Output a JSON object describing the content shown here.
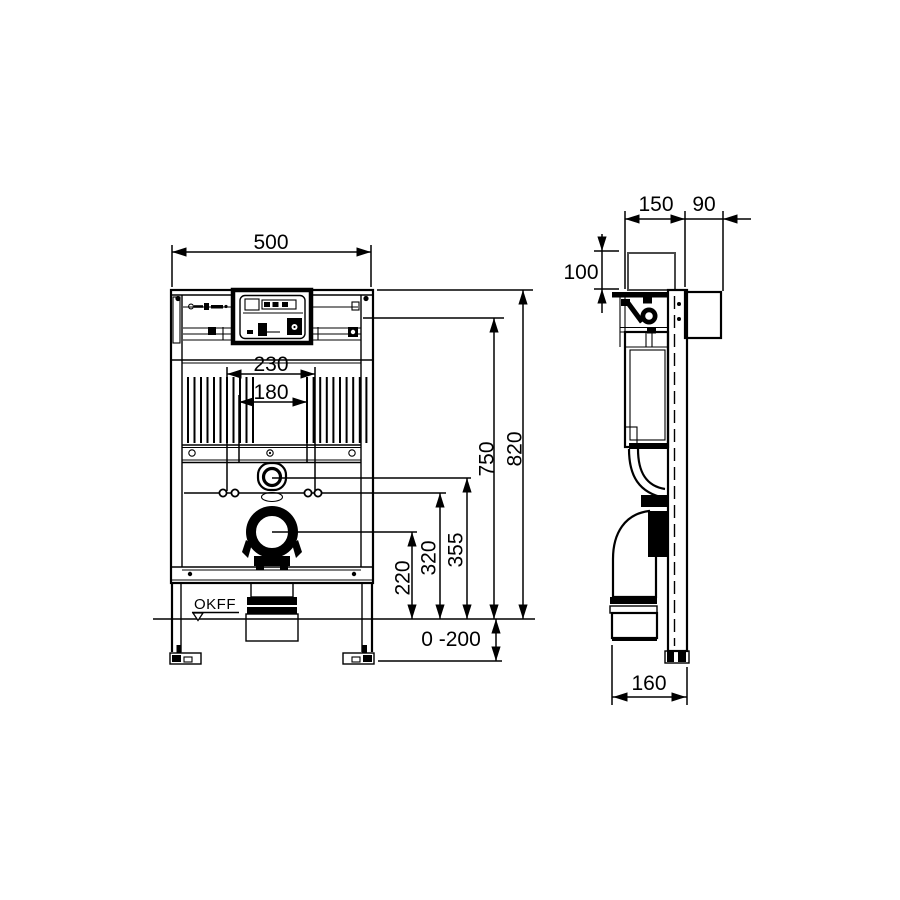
{
  "drawing": {
    "type": "technical-installation-drawing",
    "views": {
      "front": "front elevation",
      "side": "side elevation"
    },
    "colors": {
      "line": "#000000",
      "background": "#ffffff",
      "secondary_line": "#4a4a4a"
    },
    "front": {
      "width": "500",
      "fixing_spacing_outer": "230",
      "fixing_spacing_inner": "180",
      "total_height": "820",
      "upper_leader_height": "750",
      "flush_bend_height": "355",
      "fixing_height": "320",
      "drain_height": "220",
      "leg_adjustment": "0 -200",
      "floor_level": "OKFF"
    },
    "side": {
      "frame_depth": "150",
      "wall_bracket_depth": "90",
      "top_clearance": "100",
      "drain_outlet_depth": "160"
    }
  }
}
